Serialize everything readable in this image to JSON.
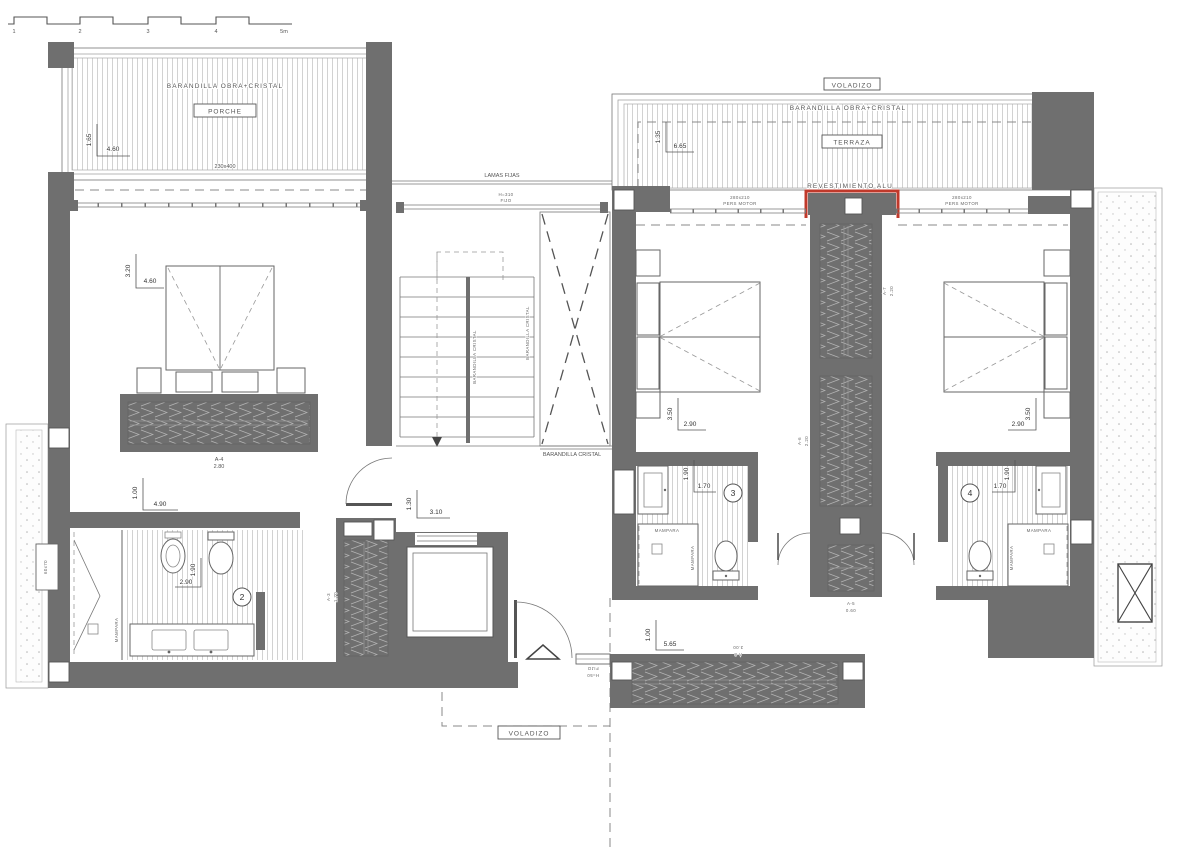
{
  "colors": {
    "wall": "#6f6f6f",
    "accent-red": "#c0392b",
    "paper": "#ffffff"
  },
  "scale_bar": {
    "ticks": [
      "1",
      "2",
      "3",
      "4",
      "5m"
    ]
  },
  "porch": {
    "railing_label": "BARANDILLA OBRA+CRISTAL",
    "name": "PORCHE",
    "dim_depth": "1.65",
    "dim_width": "4.60",
    "window_size": "230x400"
  },
  "left_wing": {
    "bedroom": {
      "dim_depth": "3.20",
      "dim_width": "4.60",
      "closet_code": "A-4",
      "closet_length": "2.80"
    },
    "bathroom": {
      "number": "2",
      "dim_offset": "1.00",
      "dim_width_top": "4.90",
      "dim_width": "2.90",
      "dim_depth": "1.90",
      "screen_label": "MAMPARA",
      "window_size": "60x70"
    }
  },
  "stair_hall": {
    "lamas_label": "LAMAS FIJAS",
    "window_height": "H=310",
    "window_type": "FIJO",
    "rail_left": "BARANDILLA CRISTAL",
    "rail_right": "BARANDILLA CRISTAL",
    "rail_bottom": "BARANDILLA CRISTAL",
    "dim_offset": "1.30",
    "dim_width": "3.10",
    "closet_code": "A-3",
    "closet_length": "1.70"
  },
  "entry": {
    "window_height": "H=50",
    "window_type": "FIJO",
    "overhang_label": "VOLADIZO"
  },
  "terrace": {
    "overhang_label": "VOLADIZO",
    "railing_label": "BARANDILLA OBRA+CRISTAL",
    "name": "TERRAZA",
    "dim_depth": "1.35",
    "dim_width": "6.65",
    "cladding_label": "REVESTIMIENTO ALU",
    "shutter_left_size": "280x210",
    "shutter_left_type": "PERS MOTOR",
    "shutter_right_size": "280x210",
    "shutter_right_type": "PERS MOTOR"
  },
  "bedroom3": {
    "dim_depth": "3.50",
    "dim_width": "2.90"
  },
  "bedroom4": {
    "dim_depth": "3.50",
    "dim_width": "2.90"
  },
  "bathroom3": {
    "number": "3",
    "dim_depth": "1.90",
    "dim_width": "1.70",
    "screen_top": "MAMPARA",
    "screen_side": "MAMPARA"
  },
  "bathroom4": {
    "number": "4",
    "dim_depth": "1.90",
    "dim_width": "1.70",
    "screen_top": "MAMPARA",
    "screen_side": "MAMPARA"
  },
  "corridor": {
    "closet_a7_code": "A-7",
    "closet_a7_length": "2.20",
    "closet_a6_code": "A-6",
    "closet_a6_length": "2.20",
    "closet_a5_code": "A-5",
    "closet_a5_length": "0.60"
  },
  "bottom_room": {
    "dim_offset": "1.00",
    "dim_width": "5.65",
    "closet_code": "A-8",
    "closet_length": "3.00"
  }
}
